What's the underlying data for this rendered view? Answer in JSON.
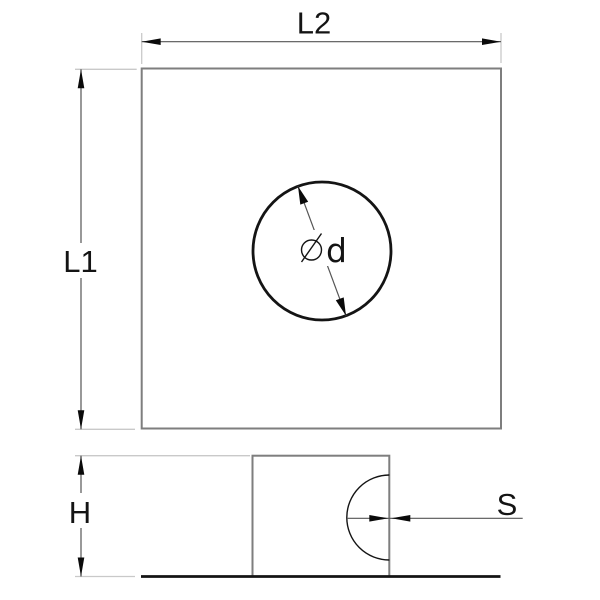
{
  "drawing": {
    "type": "technical-drawing",
    "description": "Square plate with centered round hole, top view and side profile view",
    "labels": {
      "top_width": "L2",
      "left_height": "L1",
      "hole_diameter_letter": "d",
      "profile_height": "H",
      "wall_thickness": "S"
    },
    "icons": {
      "diameter_symbol": "⌀",
      "arrowhead": "filled triangle dimension arrowhead"
    },
    "colors": {
      "background": "#ffffff",
      "outline": "#7e7e7e",
      "feature": "#141414",
      "dimension": "#555555",
      "extension": "#c9c9c9",
      "arrow": "#0a0a0a",
      "text": "#141414"
    }
  }
}
